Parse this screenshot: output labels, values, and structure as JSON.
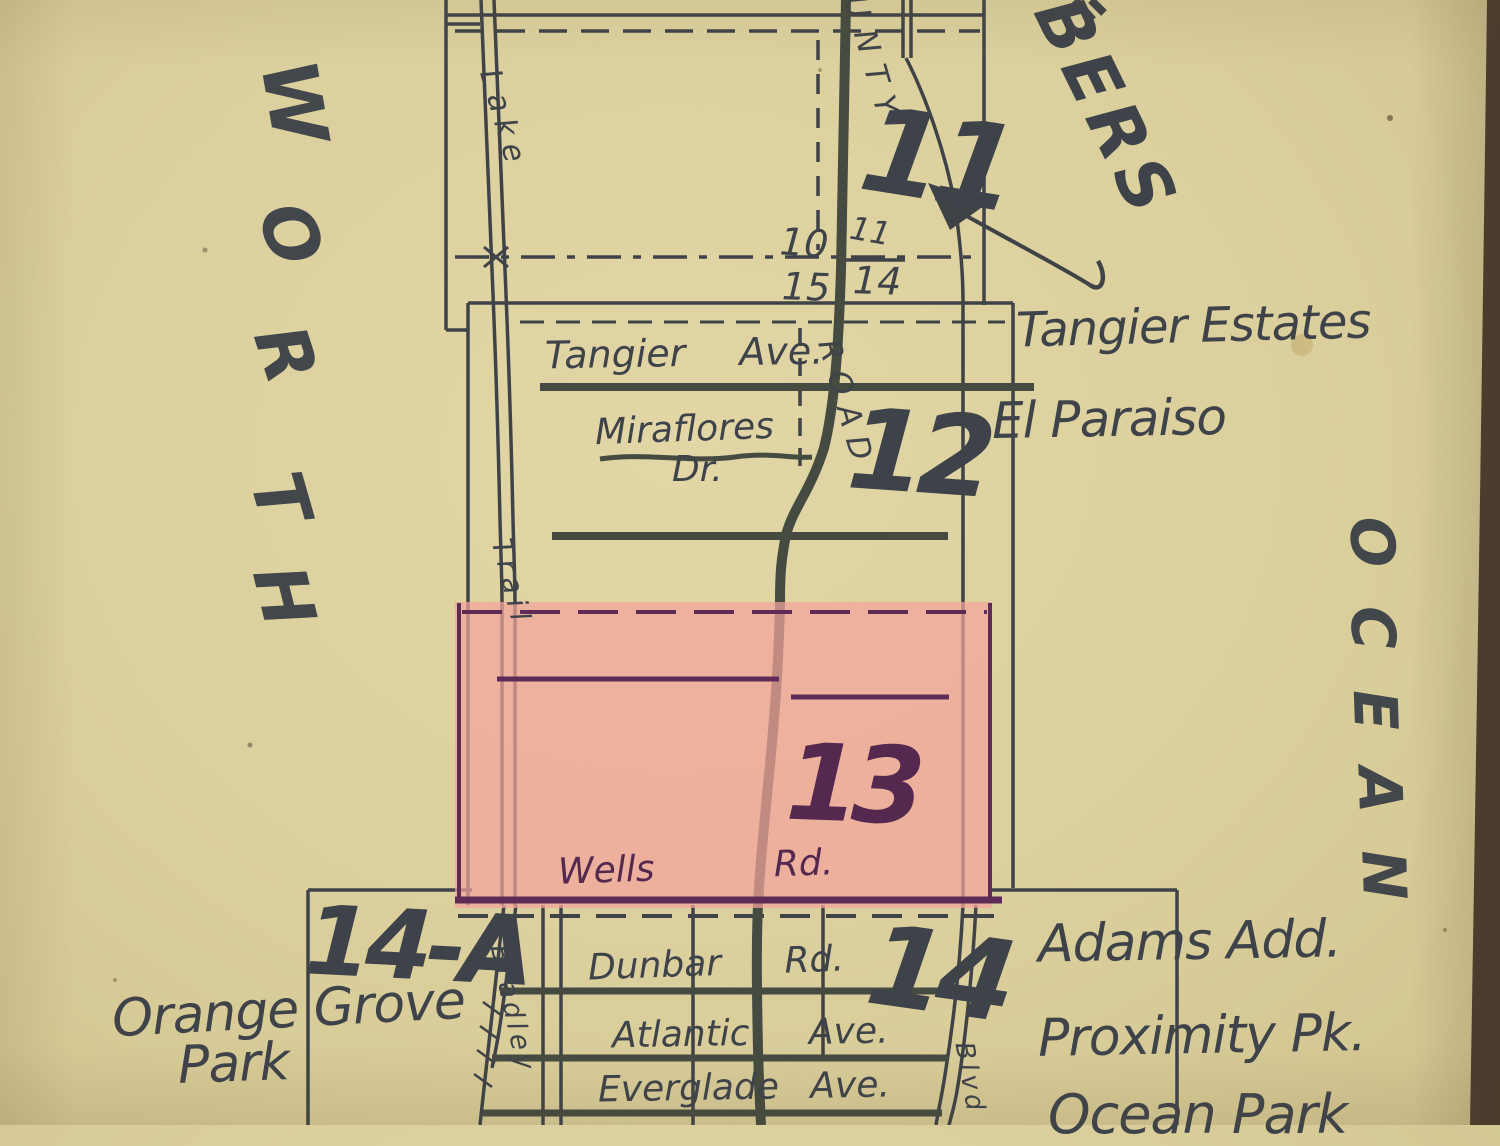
{
  "map": {
    "shores": {
      "west": [
        "W",
        "O",
        "R",
        "T",
        "H"
      ],
      "east": [
        "O",
        "C",
        "E",
        "A",
        "N"
      ]
    },
    "corner_text": {
      "fragment": "BERS"
    },
    "section_numbers": {
      "s11": "11",
      "s12": "12",
      "s13": "13",
      "s14": "14",
      "s14a": "14-A"
    },
    "corner_numbers": {
      "nw": "10",
      "ne": "11",
      "sw": "15",
      "se": "14"
    },
    "road_names": {
      "county_upper": "UNTY",
      "county_lower": "ROAD",
      "lake": "Lake",
      "trail": "Trail",
      "bradley": "Bradley",
      "coastal": "Blvd",
      "tangier_ave": "Tangier Ave.",
      "miraflores": "Miraflores",
      "miraflores_suffix": "Dr.",
      "wells_rd": "Wells Rd.",
      "dunbar_rd": "Dunbar Rd.",
      "atlantic_ave": "Atlantic Ave.",
      "everglade_ave": "Everglade Ave."
    },
    "place_names": {
      "tangier_estates": "Tangier Estates",
      "el_paraiso": "El Paraiso",
      "adams_add": "Adams Add.",
      "proximity_pk": "Proximity Pk.",
      "ocean_park": "Ocean Park",
      "orange_grove": "Orange Grove",
      "orange_grove_line2": "Park"
    },
    "colors": {
      "paper": "#dbcf9d",
      "ink": "#3f4449",
      "road_ink": "#454b41",
      "highlight_purple": "#5e2b56",
      "highlight_pink": "#f3a49b",
      "photo_edge": "#4c3d30"
    }
  }
}
